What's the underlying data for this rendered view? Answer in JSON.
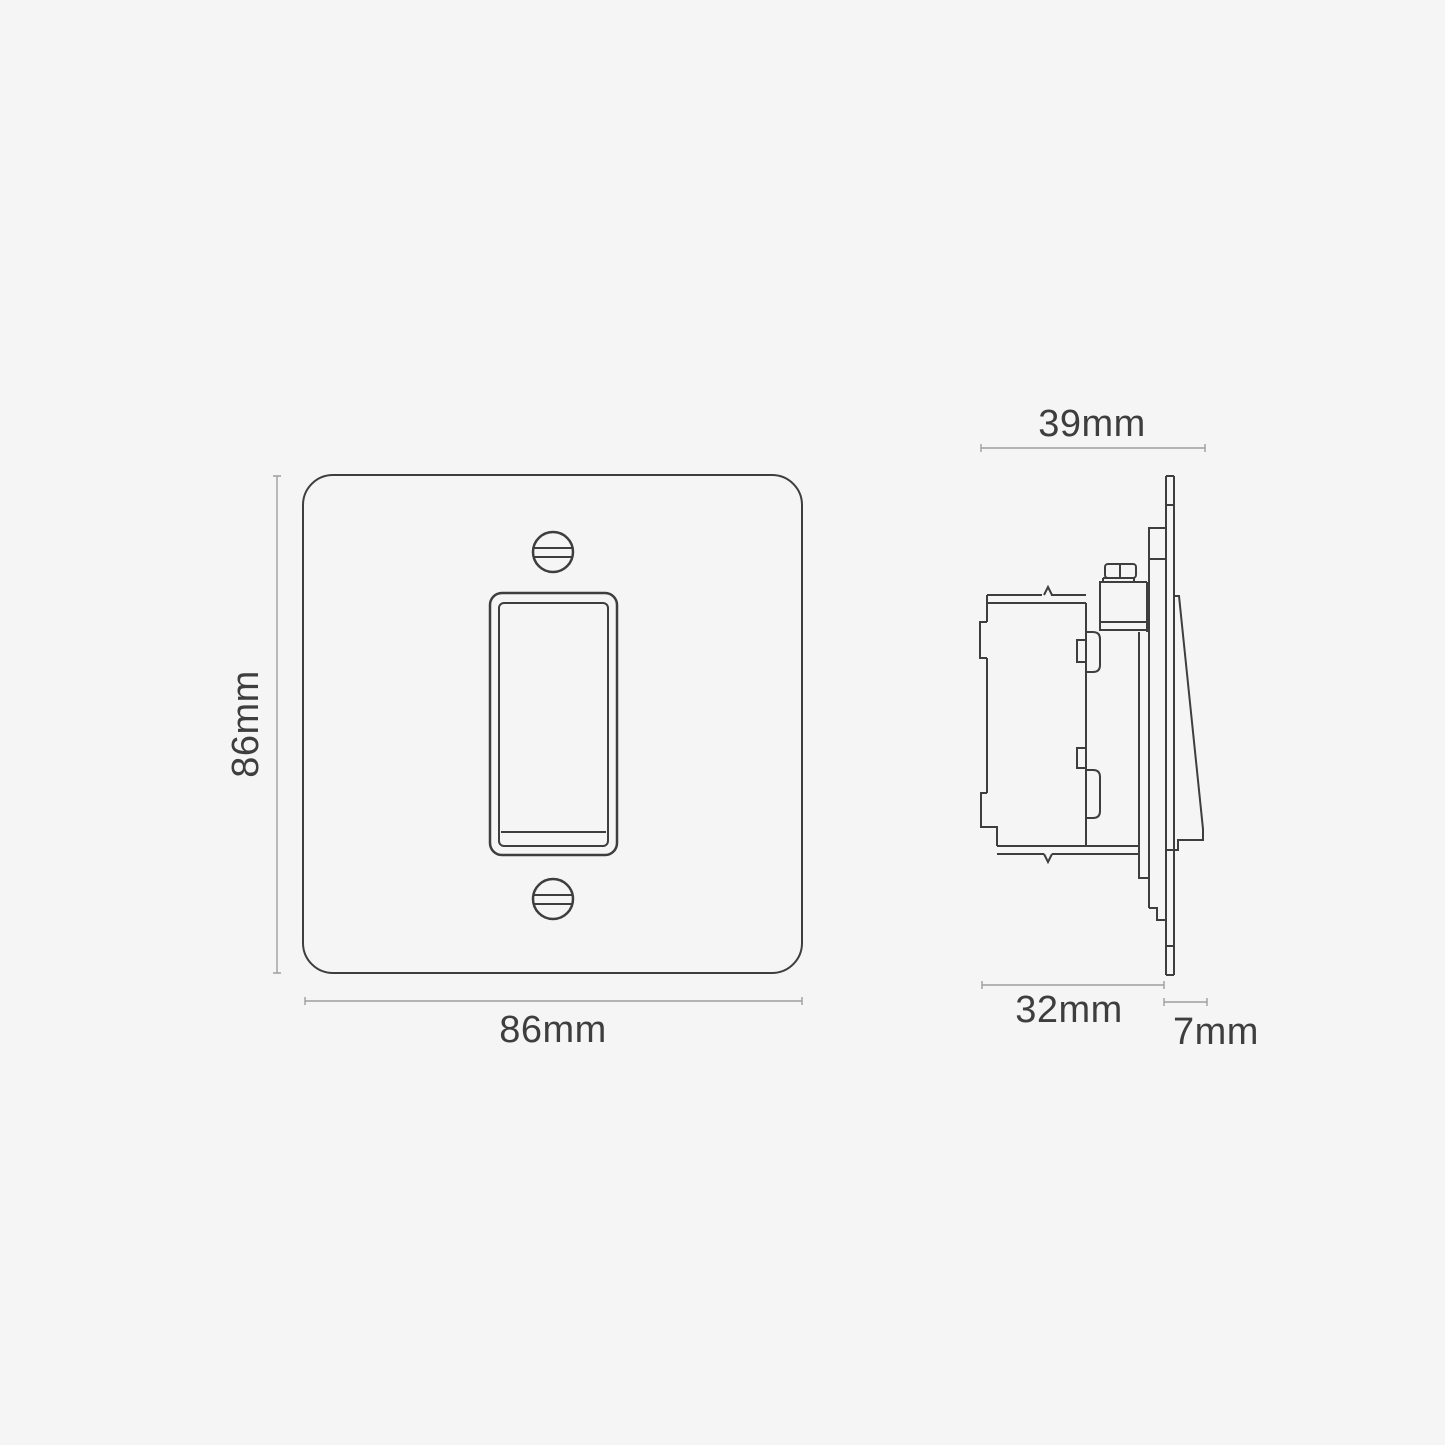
{
  "colors": {
    "background": "#f5f5f6",
    "outline": "#3e3e3e",
    "dimension_line": "#9e9e9e",
    "label_text": "#3e3e3e"
  },
  "front_view": {
    "height_label": "86mm",
    "width_label": "86mm"
  },
  "side_view": {
    "overall_depth_label": "39mm",
    "mechanism_depth_label": "32mm",
    "faceplate_depth_label": "7mm"
  }
}
